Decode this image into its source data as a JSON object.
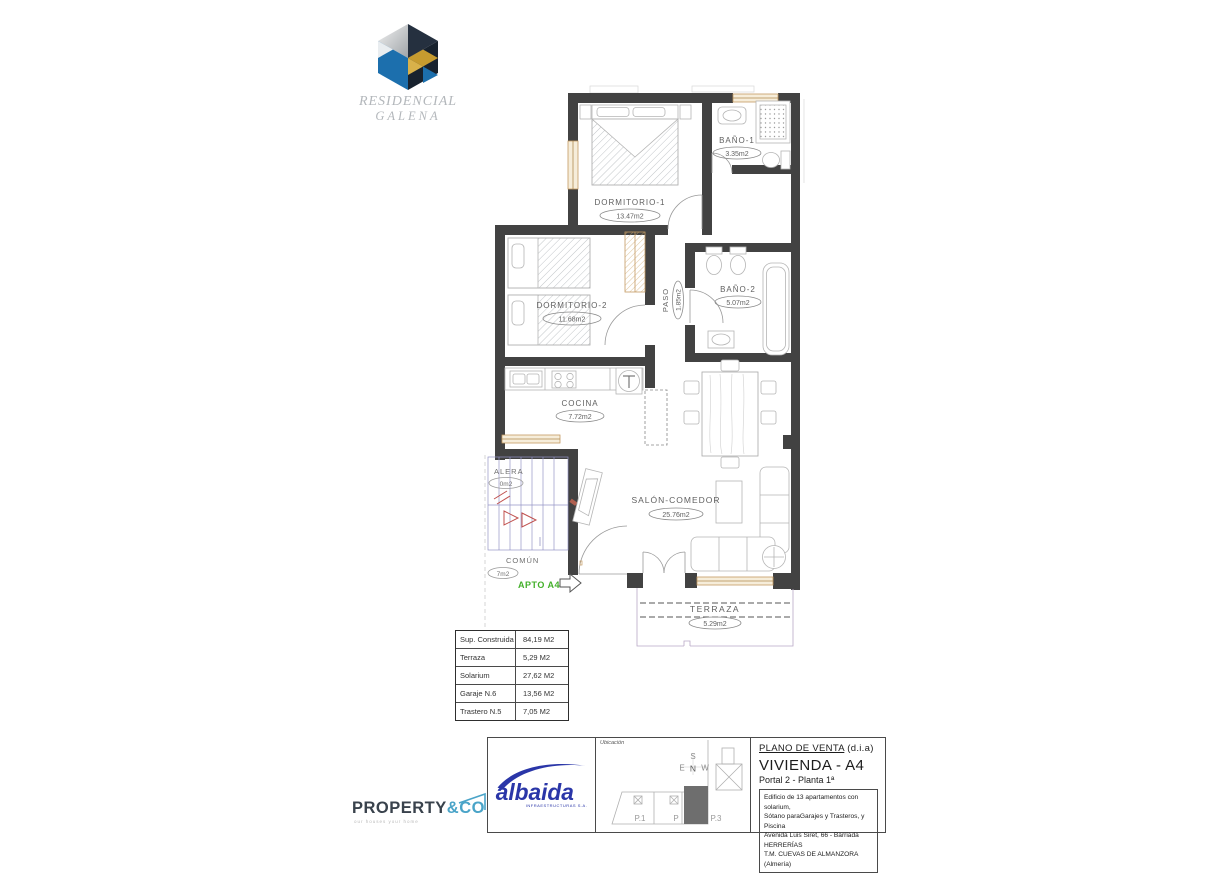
{
  "brand": {
    "line1": "RESIDENCIAL",
    "line2": "GALENA"
  },
  "floorplan": {
    "rooms": [
      {
        "name": "DORMITORIO-1",
        "area": "13.47m2"
      },
      {
        "name": "BAÑO-1",
        "area": "3.35m2"
      },
      {
        "name": "DORMITORIO-2",
        "area": "11.68m2"
      },
      {
        "name": "PASO",
        "area": "1.85m2"
      },
      {
        "name": "BAÑO-2",
        "area": "5.07m2"
      },
      {
        "name": "COCINA",
        "area": "7.72m2"
      },
      {
        "name": "SALÓN-COMEDOR",
        "area": "25.76m2"
      },
      {
        "name": "TERRAZA",
        "area": "5.29m2"
      }
    ],
    "common": {
      "escalera_label": "ALERA",
      "escalera_area": "0m2",
      "comun_label": "COMÚN",
      "comun_area": "7m2",
      "apto_label": "APTO A4"
    }
  },
  "surface_table": {
    "rows": [
      {
        "label": "Sup. Construida",
        "value": "84,19 M2"
      },
      {
        "label": "Terraza",
        "value": "5,29 M2"
      },
      {
        "label": "Solarium",
        "value": "27,62 M2"
      },
      {
        "label": "Garaje  N.6",
        "value": "13,56 M2"
      },
      {
        "label": "Trastero  N.5",
        "value": "7,05 M2"
      }
    ]
  },
  "title_block": {
    "company": {
      "name": "albaida",
      "subtitle": "INFRAESTRUCTURAS S.A."
    },
    "location_panel": {
      "label": "Ubicación",
      "compass": {
        "top": "S",
        "left": "E",
        "center": "N",
        "right": "W"
      },
      "portals": [
        "P.1",
        "P",
        "P.3"
      ]
    },
    "plan_type": "PLANO DE VENTA",
    "plan_type_suffix": "(d.i.a)",
    "dwelling": "VIVIENDA - A4",
    "portal_floor": "Portal 2 - Planta 1ª",
    "description": [
      "Edificio de 13 apartamentos con solarium,",
      "Sótano paraGarajes y Trasteros, y Piscina",
      "Avenida Luis Siret, 66 - Barriada HERRERÍAS",
      "T.M. CUEVAS DE ALMANZORA (Almería)"
    ]
  },
  "footer": {
    "agency": {
      "name_main": "PROPERTY",
      "name_accent": "&CO",
      "tagline": "our houses your home"
    }
  },
  "colors": {
    "wall": "#424242",
    "window_frame": "#c49a62",
    "apto_green": "#43b02a",
    "stairs_blue": "#9494c6",
    "stairs_arrow_red": "#c0504d",
    "albaida_blue": "#2a36a8",
    "agency_dark": "#39424c",
    "agency_teal": "#4aa4c8",
    "logo_cube_blue": "#1c6fad",
    "logo_cube_navy": "#25303f",
    "logo_cube_gold": "#c69b2f"
  }
}
